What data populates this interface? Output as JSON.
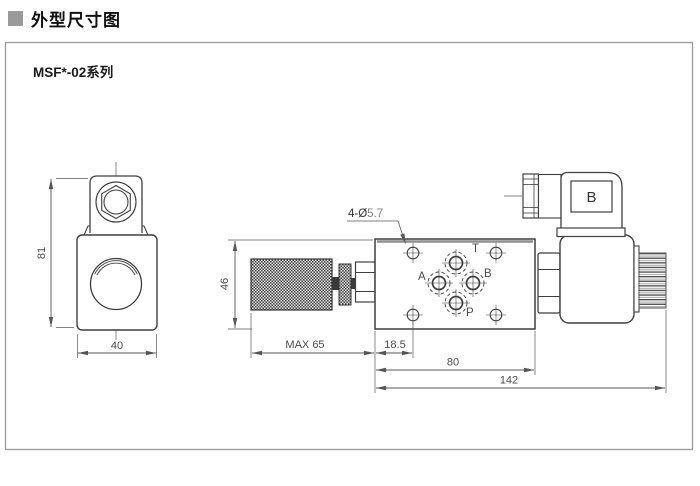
{
  "page": {
    "section_title": "外型尺寸图",
    "series_label": "MSF*-02系列"
  },
  "front_view": {
    "dim_height": "81",
    "dim_width": "40"
  },
  "side_view": {
    "dim_body_height": "46",
    "dim_knob_extension": "MAX 65",
    "dim_hole_offset": "18.5",
    "dim_body_length": "80",
    "dim_overall_length": "142",
    "mount_holes_prefix": "4-Ø",
    "mount_holes_value": "5.7",
    "port_t": "T",
    "port_a": "A",
    "port_b": "B",
    "port_p": "P"
  },
  "connector": {
    "label": "B"
  },
  "colors": {
    "outline": "#3f3f3f",
    "dimension": "#555555",
    "title_marker": "#9a9a9a",
    "knurl_dark": "#3d3d3d",
    "frame_border": "#9e9e9e"
  }
}
